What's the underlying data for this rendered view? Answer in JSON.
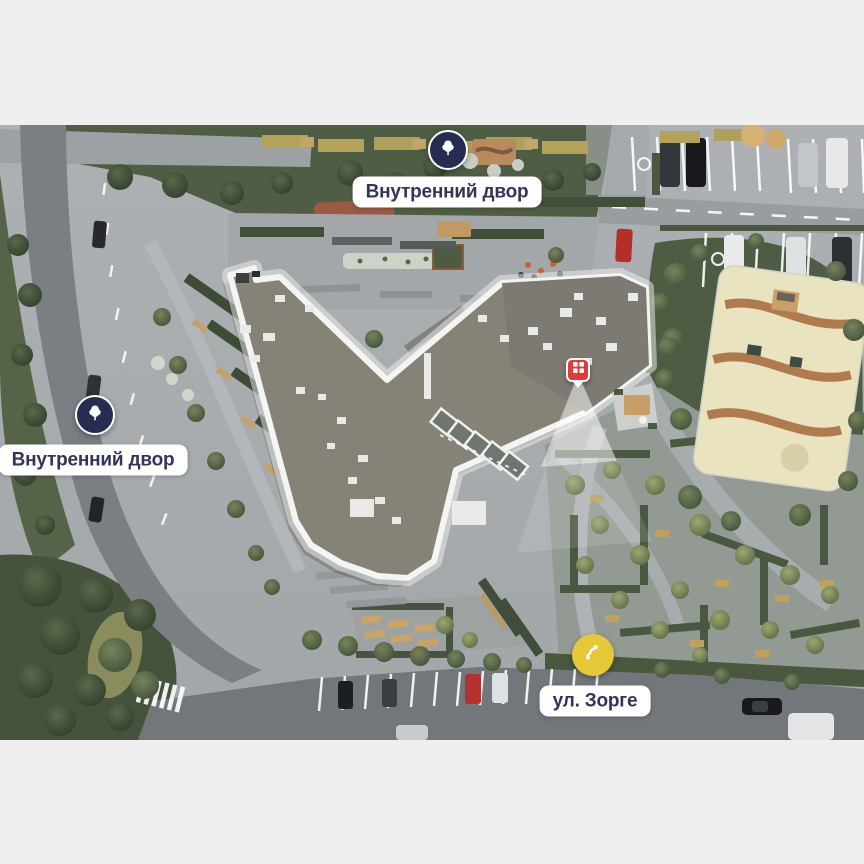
{
  "colors": {
    "page-bg": "#efefef",
    "navy": "#282c50",
    "yellow": "#e5c838",
    "red": "#e03b38",
    "label-bg": "#ffffff",
    "label-text": "#31355b"
  },
  "markers": {
    "courtyard_top": {
      "label": "Внутренний двор",
      "icon": "tree-icon"
    },
    "courtyard_left": {
      "label": "Внутренний двор",
      "icon": "tree-icon"
    },
    "street": {
      "label": "ул. Зорге",
      "icon": "route-icon"
    },
    "building": {
      "icon": "building-window-icon"
    }
  }
}
